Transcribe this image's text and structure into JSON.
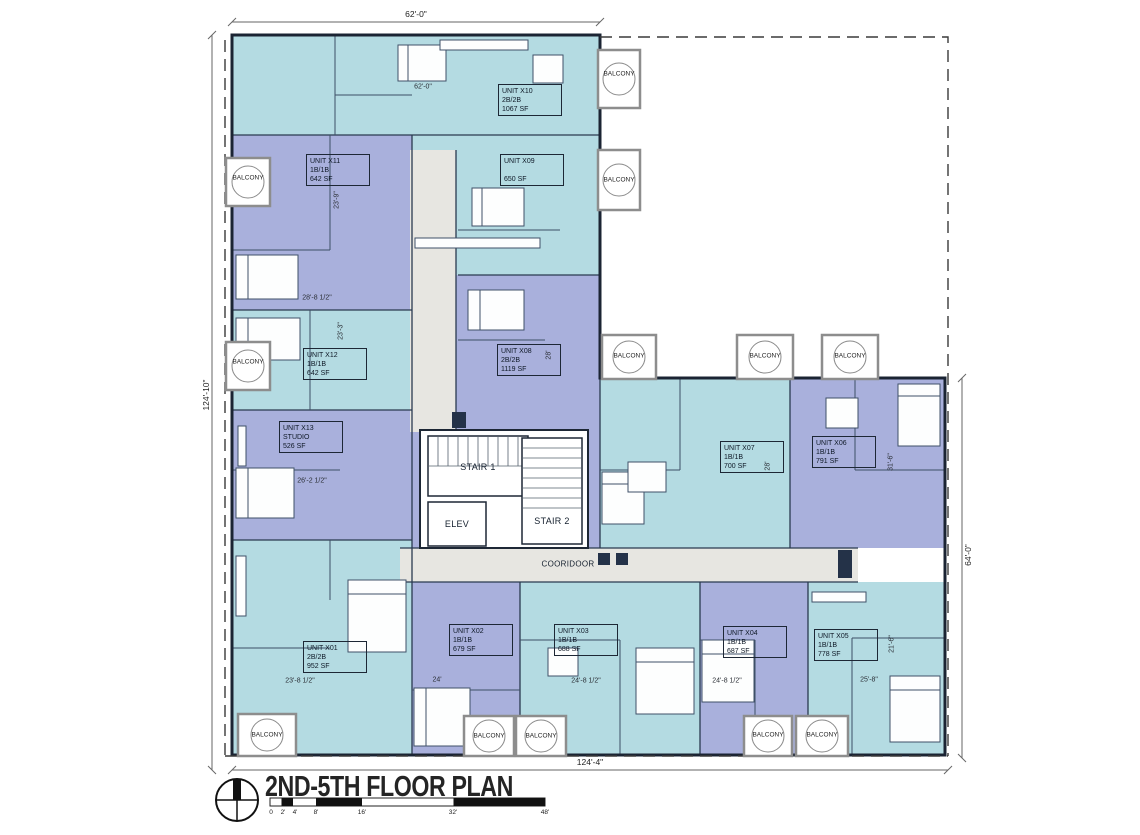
{
  "title": "2ND-5TH FLOOR PLAN",
  "colors": {
    "unit_light_blue": "#b4dbe2",
    "unit_periwinkle": "#a9b0dc",
    "corridor_gray": "#e7e6e1",
    "wall": "#1d2735",
    "balcony_border": "#8d8d8d"
  },
  "units": [
    {
      "name": "UNIT X01",
      "config": "2B/2B",
      "area": "952 SF"
    },
    {
      "name": "UNIT X02",
      "config": "1B/1B",
      "area": "679 SF"
    },
    {
      "name": "UNIT X03",
      "config": "1B/1B",
      "area": "688 SF"
    },
    {
      "name": "UNIT X04",
      "config": "1B/1B",
      "area": "687 SF"
    },
    {
      "name": "UNIT X05",
      "config": "1B/1B",
      "area": "778 SF"
    },
    {
      "name": "UNIT X06",
      "config": "1B/1B",
      "area": "791 SF"
    },
    {
      "name": "UNIT X07",
      "config": "1B/1B",
      "area": "700 SF"
    },
    {
      "name": "UNIT X08",
      "config": "2B/2B",
      "area": "1119 SF"
    },
    {
      "name": "UNIT X09",
      "config": "",
      "area": "650 SF"
    },
    {
      "name": "UNIT X10",
      "config": "2B/2B",
      "area": "1067 SF"
    },
    {
      "name": "UNIT X11",
      "config": "1B/1B",
      "area": "642 SF"
    },
    {
      "name": "UNIT X12",
      "config": "1B/1B",
      "area": "642 SF"
    },
    {
      "name": "UNIT X13",
      "config": "STUDIO",
      "area": "526 SF"
    }
  ],
  "core": {
    "stair1": "STAIR 1",
    "stair2": "STAIR 2",
    "elevator": "ELEV",
    "corridor": "COORIDOOR"
  },
  "balcony_label": "BALCONY",
  "dimensions": {
    "top": "62'-0\"",
    "left": "124'-10\"",
    "right": "64'-0\"",
    "bottom": "124'-4\"",
    "interior": [
      "62'-0\"",
      "23'-9\"",
      "28'-8 1/2\"",
      "23'-3\"",
      "26'-2 1/2\"",
      "28'",
      "28'",
      "31'-6\"",
      "23'-8 1/2\"",
      "24'",
      "24'-8 1/2\"",
      "24'-8 1/2\"",
      "25'-8\"",
      "21'-6\""
    ]
  },
  "scale_bar": {
    "labels": [
      "0",
      "2'",
      "4'",
      "8'",
      "16'",
      "32'",
      "48'"
    ]
  }
}
